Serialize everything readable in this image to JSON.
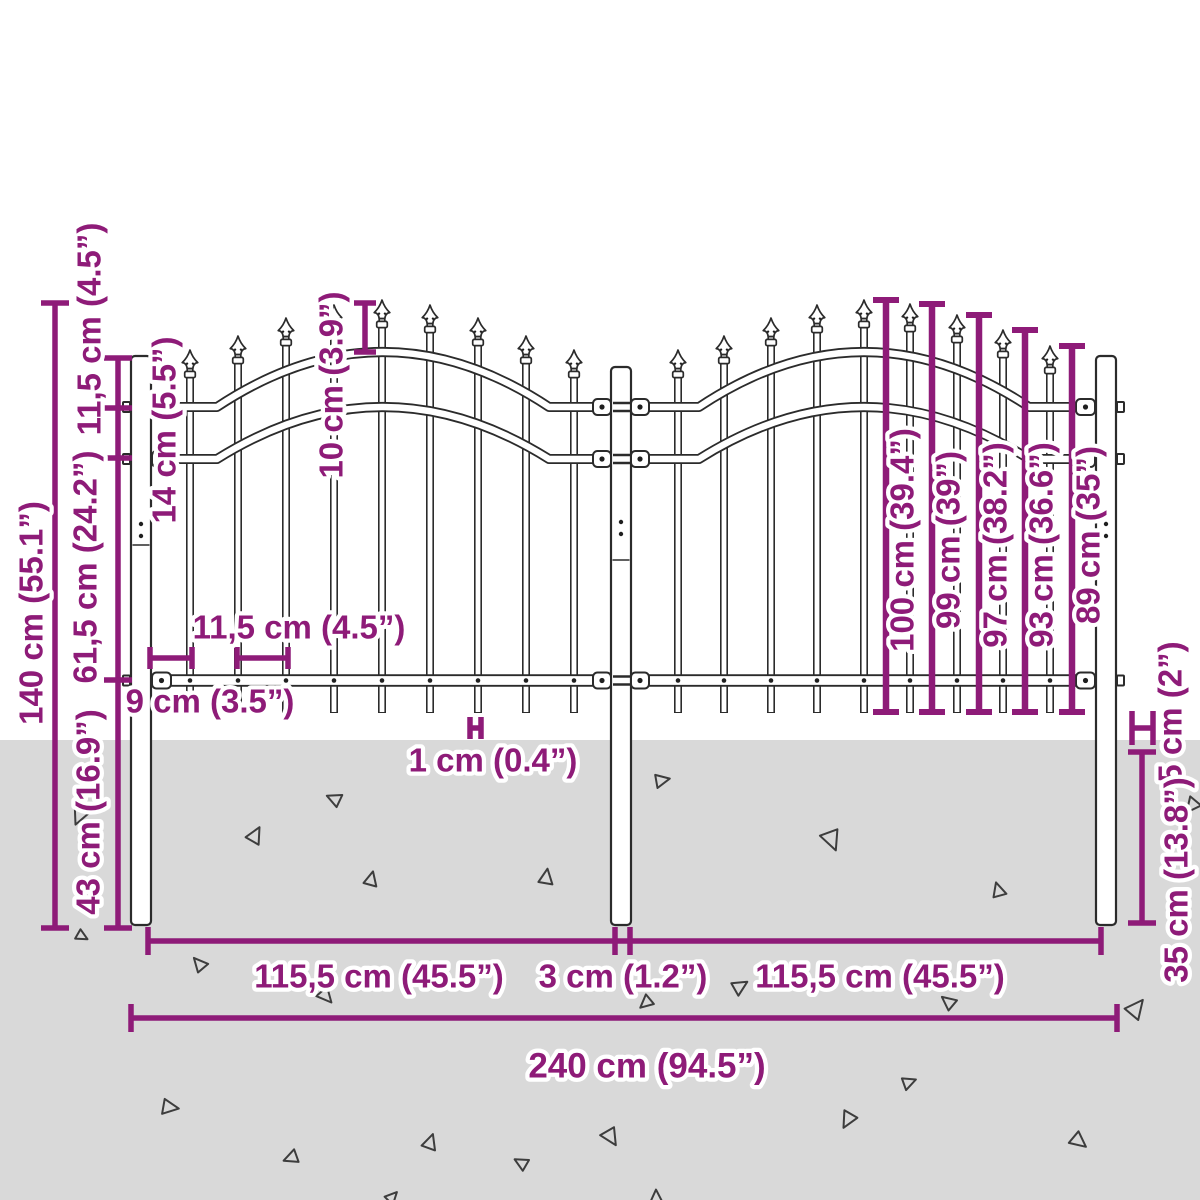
{
  "title": "Garden fence panel dimension diagram",
  "colors": {
    "accent": "#8e1b78",
    "ground": "#d9d9d9",
    "fence_line": "#2b2b2b",
    "background": "#ffffff"
  },
  "dims": {
    "total_height": "140 cm (55.1”)",
    "post_top_above_upper_rail": "11,5 cm (4.5”)",
    "rail_spacing": "14 cm (5.5”)",
    "upper_rail_to_bottom_rail": "61,5 cm (24.2”)",
    "bottom_rail_to_post_bottom": "43 cm (16.9”)",
    "finial_above_rail": "10 cm (3.9”)",
    "picket_spacing": "11,5 cm (4.5”)",
    "post_to_first_picket": "9 cm (3.5”)",
    "picket_width": "1 cm (0.4”)",
    "picket_heights": [
      "100 cm (39.4”)",
      "99 cm (39”)",
      "97 cm (38.2”)",
      "93 cm (36.6”)",
      "89 cm (35”)"
    ],
    "post_above_ground_gap": "5 cm (2”)",
    "post_underground_depth": "35 cm (13.8”)",
    "left_section_width": "115,5 cm (45.5”)",
    "center_post_gap": "3 cm (1.2”)",
    "right_section_width": "115,5 cm (45.5”)",
    "total_width": "240 cm (94.5”)"
  }
}
